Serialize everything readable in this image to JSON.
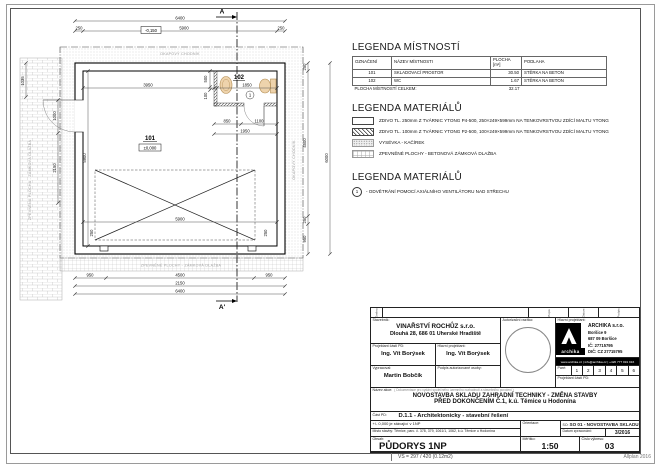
{
  "plan": {
    "section_top": "A",
    "section_bottom": "A'",
    "vent_marker": "1",
    "rooms": {
      "r101": {
        "num": "101",
        "elev": "±0,000"
      },
      "r102": {
        "num": "102"
      }
    },
    "labels": {
      "top_band": "OKAPOVÝ CHODNÍK",
      "bottom_band": "ZPEVNĚNÉ PLOCHY - ZÁMKOVÁ DLAŽBA",
      "left_band": "ZPEVNĚNÁ PLOCHA - ZÁMKOVÁ DLAŽBA",
      "right_band": "OKAPOVÝ CHODNÍK"
    },
    "dims": {
      "top_total": "6400",
      "top_a": "250",
      "top_b": "5900",
      "top_c": "250",
      "top_elev": "-0,150",
      "left_a": "1035",
      "left_b": "1000",
      "left_c": "2150",
      "left_inner": "5900",
      "right_a": "250",
      "right_b": "4500",
      "right_c": "250",
      "right_d": "950",
      "right_total": "6000",
      "inner_w": "3950",
      "wc_w": "1850",
      "aux_500": "500",
      "aux_100": "100",
      "door_a": "850",
      "door_b": "1100",
      "door_c": "1950",
      "inner_bottom": "5900",
      "corner_a": "250",
      "corner_b": "250",
      "bot_a": "950",
      "bot_b": "4500",
      "bot_c": "950",
      "bot_mid": "2150",
      "bot_total": "6400"
    }
  },
  "legend_rooms": {
    "title": "LEGENDA MÍSTNOSTÍ",
    "headers": {
      "c1": "OZNAČENÍ",
      "c2": "NÁZEV MÍSTNOSTI",
      "c3": "PLOCHA [m²]",
      "c4": "PODLAHA"
    },
    "rows": [
      {
        "id": "101",
        "name": "SKLADOVACÍ PROSTOR",
        "area": "30.50",
        "floor": "STĚRKA NA BETON"
      },
      {
        "id": "102",
        "name": "WC",
        "area": "1.67",
        "floor": "STĚRKA NA BETON"
      }
    ],
    "total_label": "PLOCHA MÍSTNOSTÍ CELKEM:",
    "total_value": "32.17"
  },
  "legend_materials": {
    "title": "LEGENDA MATERIÁLŮ",
    "items": [
      {
        "text": "ZDIVO TL. 250mm Z TVÁRNIC YTONG P4-500, 250×249×599mm NA TENKOVRSTVOU ZDÍCÍ MALTU YTONG"
      },
      {
        "text": "ZDIVO TL. 100mm Z TVÁRNIC YTONG P2-500, 100×249×599mm NA TENKOVRSTVOU ZDÍCÍ MALTU YTONG"
      },
      {
        "text": "VYSÉVKA - KAČÍREK"
      },
      {
        "text": "ZPEVNĚNÉ PLOCHY - BETONOVÁ ZÁMKOVÁ DLAŽBA"
      }
    ]
  },
  "legend_symbols": {
    "title": "LEGENDA MATERIÁLŮ",
    "marker": "1",
    "text": "- ODVĚTRÁNÍ POMOCÍ AXIÁLNÍHO VENTILÁTORU NAD STŘECHU"
  },
  "titleblock": {
    "rev": {
      "zmena": "Změna",
      "popis": "Popis",
      "datum": "Datum",
      "podpis": "Podpis"
    },
    "stavebnik_label": "Stavebník:",
    "stavebnik_name": "VINAŘSTVÍ ROCHŮZ s.r.o.",
    "stavebnik_addr": "Dlouhá 28, 686 01 Uherské Hradiště",
    "razitko_label": "Autorizační razítko:",
    "hl_projektant_label": "Hlavní projektant:",
    "firm": {
      "name": "ARCHIKA s.r.o.",
      "addr1": "Boršice 9",
      "addr2": "687 09 Boršice",
      "ic": "IČ: 27715795",
      "dic": "DIČ: CZ 27715795",
      "logo_text": "archika",
      "contact": "www.archika.cz | info@archika.cz | +420 777 991 916"
    },
    "proj_casti_label": "Projektant části PD:",
    "proj_casti_name": "Ing. Vít Borýsek",
    "hl_proj2_label": "Hlavní projektant:",
    "hl_proj2_name": "Ing. Vít Borýsek",
    "vypracoval_label": "Vypracoval:",
    "vypracoval_name": "Martin Bobčík",
    "podpis_label": "Podpis autorizované osoby:",
    "pare_label": "Paré:",
    "pare": [
      "1",
      "2",
      "3",
      "4",
      "5",
      "6"
    ],
    "proj_casti2_label": "Projektant části PD:",
    "nazev_label": "Název akce:",
    "nazev_note": "( Dokumentace pro vydání společného územního rozhodnutí a stavebního povolení )",
    "nazev_line1": "NOVOSTAVBA SKLADU ZAHRADNÍ TECHNIKY - ZMĚNA STAVBY",
    "nazev_line2": "PŘED DOKONČENÍM Č.1, k.ú. Těmice u Hodonína",
    "cast_label": "Část PD:",
    "cast_value": "D.1.1 - Architektonicky - stavební řešení",
    "elev_note": "+/- 0,000 je stávající v 1NP",
    "misto_label": "Místo stavby:",
    "misto_value": "Těmice, parc. č. 378, 379, 1061/1, 1062, k.ú. Těmice u Hodonína",
    "obsah_label": "Obsah:",
    "obsah_value": "PŮDORYS 1NP",
    "orientace_label": "Orientace:",
    "so_label": "SO:",
    "so_value": "SO 01 - NOVOSTAVBA SKLADU",
    "datum_label": "Datum zpracování:",
    "datum_value": "3/2016",
    "meritko_label": "Měřítko:",
    "meritko_value": "1:50",
    "cislo_label": "Číslo výkresu:",
    "cislo_value": "03"
  },
  "footer": {
    "left": "VŠ = 297 / 420 (0.12m2)",
    "right": "Allplan 2016"
  }
}
